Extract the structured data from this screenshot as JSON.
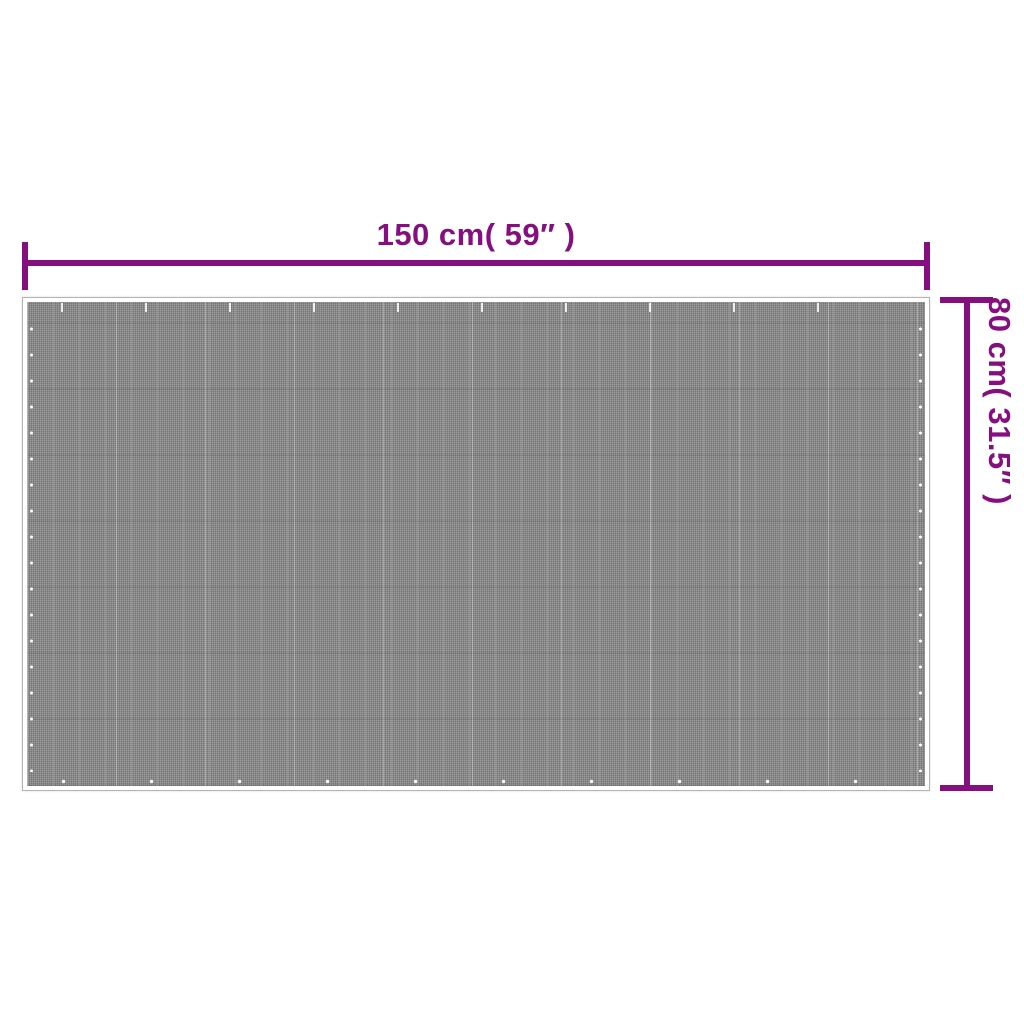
{
  "diagram": {
    "width_dimension": {
      "label": "150 cm( 59″ )"
    },
    "height_dimension": {
      "label": "80 cm( 31.5″ )"
    },
    "colors": {
      "accent": "#860F80",
      "mat_base": "#8F8F8F",
      "mat_border": "#FFFFFF",
      "mat_outline": "#B3B3B3",
      "background": "#FFFFFF"
    }
  }
}
